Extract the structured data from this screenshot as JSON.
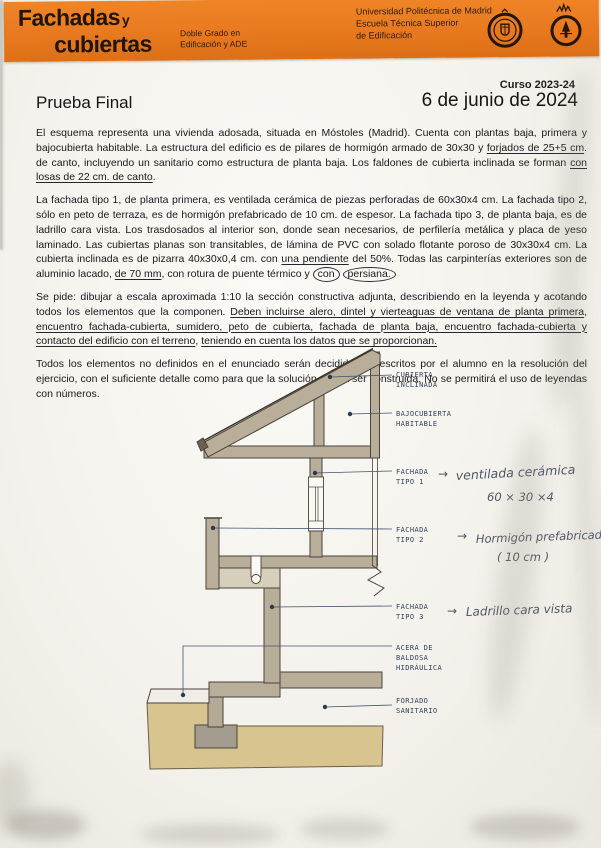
{
  "colors": {
    "banner_orange": "#e8791f",
    "ink_blue": "#33415c",
    "wash_tan": "#b8ae99",
    "ground_tan": "#d8c48f",
    "footing_gray": "#a49c8f"
  },
  "header": {
    "title_word1": "Fachadas",
    "title_conj": "y",
    "title_word2": "cubiertas",
    "program": [
      "Doble Grado en",
      "Edificación y ADE"
    ],
    "university": [
      "Universidad Politécnica de Madrid",
      "Escuela Técnica Superior",
      "de Edificación"
    ],
    "seal_left": "upm-seal",
    "seal_right": "school-seal"
  },
  "meta": {
    "course": "Curso 2023-24",
    "exam_title": "Prueba Final",
    "date": "6 de junio de 2024"
  },
  "paragraphs": [
    [
      {
        "t": "El esquema representa una vivienda adosada, situada en Móstoles (Madrid). Cuenta con plantas baja, primera y bajocubierta habitable. La estructura del edificio es de pilares de hormigón armado de 30x30 y "
      },
      {
        "t": "forjados de 25+5 cm",
        "s": "u"
      },
      {
        "t": ". de canto, incluyendo un sanitario como estructura de planta baja. Los faldones de cubierta inclinada se forman "
      },
      {
        "t": "con losas de 22 cm. de canto",
        "s": "u"
      },
      {
        "t": "."
      }
    ],
    [
      {
        "t": "La fachada tipo 1, de planta primera, es ventilada cerámica de piezas perforadas de 60x30x4 cm. La fachada tipo 2, sólo en peto de terraza, es de hormigón prefabricado de 10 cm. de espesor. La fachada tipo 3, de planta baja, es de ladrillo cara vista. Los trasdosados al interior son, donde sean necesarios, de perfilería metálica y placa de yeso laminado. Las cubiertas planas son transitables, de lámina de PVC con solado flotante poroso de 30x30x4 cm. La cubierta inclinada es de pizarra 40x30x0,4 cm. con "
      },
      {
        "t": "una pendiente",
        "s": "u"
      },
      {
        "t": " del 50%. Todas las carpinterías exteriores son de aluminio lacado, "
      },
      {
        "t": "de 70 mm",
        "s": "u"
      },
      {
        "t": ", con rotura de puente térmico y "
      },
      {
        "t": "con",
        "s": "c"
      },
      {
        "t": " "
      },
      {
        "t": "persiana.",
        "s": "c"
      }
    ],
    [
      {
        "t": "Se pide: dibujar a escala aproximada 1:10 la sección constructiva adjunta, describiendo en la leyenda y acotando todos los elementos que la componen. "
      },
      {
        "t": "Deben incluirse alero, dintel y vierteaguas de ventana de planta primera",
        "s": "u"
      },
      {
        "t": ", "
      },
      {
        "t": "encuentro fachada-cubierta, sumidero, peto de cubierta, fachada de planta baja, encuentro fachada-cubierta  y contacto del edificio con el terreno",
        "s": "u"
      },
      {
        "t": ", "
      },
      {
        "t": "teniendo en cuenta los datos que se proporcionan.",
        "s": "u"
      }
    ],
    [
      {
        "t": "Todos los elementos no definidos en el enunciado serán decididos y descritos por el alumno en la resolución del ejercicio, con el suficiente detalle como para que la solución pueda ser construida. No se permitirá el uso de leyendas con números."
      }
    ]
  ],
  "drawing": {
    "labels": {
      "cubierta": [
        "CUBIERTA",
        "INCLINADA"
      ],
      "bajocubierta": [
        "BAJOCUBIERTA",
        "HABITABLE"
      ],
      "fachada1": [
        "FACHADA",
        "TIPO 1"
      ],
      "fachada2": [
        "FACHADA",
        "TIPO 2"
      ],
      "fachada3": [
        "FACHADA",
        "TIPO 3"
      ],
      "acera": [
        "ACERA DE",
        "BALDOSA",
        "HIDRÁULICA"
      ],
      "forjado": [
        "FORJADO",
        "SANITARIO"
      ]
    },
    "annotations": {
      "arrow": "→",
      "f1_line1": "ventilada cerámica",
      "f1_line2": "60 × 30 ×4",
      "f2_line1": "Hormigón  prefabricado",
      "f2_line2": "( 10 cm )",
      "f3_line1": "Ladrillo cara vista"
    }
  }
}
